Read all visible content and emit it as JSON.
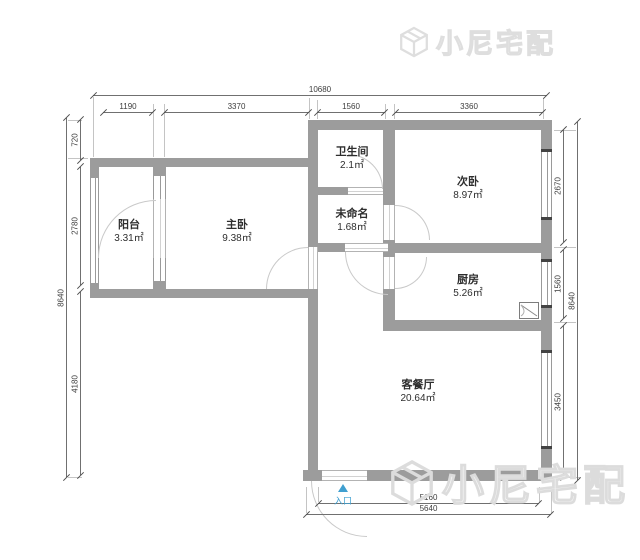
{
  "plan": {
    "rooms": [
      {
        "name": "阳台",
        "area": "3.31㎡"
      },
      {
        "name": "主卧",
        "area": "9.38㎡"
      },
      {
        "name": "卫生间",
        "area": "2.1㎡"
      },
      {
        "name": "未命名",
        "area": "1.68㎡"
      },
      {
        "name": "次卧",
        "area": "8.97㎡"
      },
      {
        "name": "厨房",
        "area": "5.26㎡"
      },
      {
        "name": "客餐厅",
        "area": "20.64㎡"
      }
    ],
    "entrance": {
      "label": "入口"
    },
    "dimensions": {
      "top_total": "10680",
      "top_segments": [
        "1190",
        "3370",
        "1560",
        "3360"
      ],
      "left_total": "8640",
      "left_segments": [
        "720",
        "2780",
        "4180"
      ],
      "right_total": "8640",
      "right_segments": [
        "2670",
        "1560",
        "3450"
      ],
      "bottom_inner": "5160",
      "bottom_outer": "5640"
    },
    "watermark": {
      "text": "小尼宅配"
    },
    "colors": {
      "wall": "#9c9c9c",
      "entrance": "#3f9fd0",
      "watermark_stroke": "#dcdcdc"
    }
  }
}
